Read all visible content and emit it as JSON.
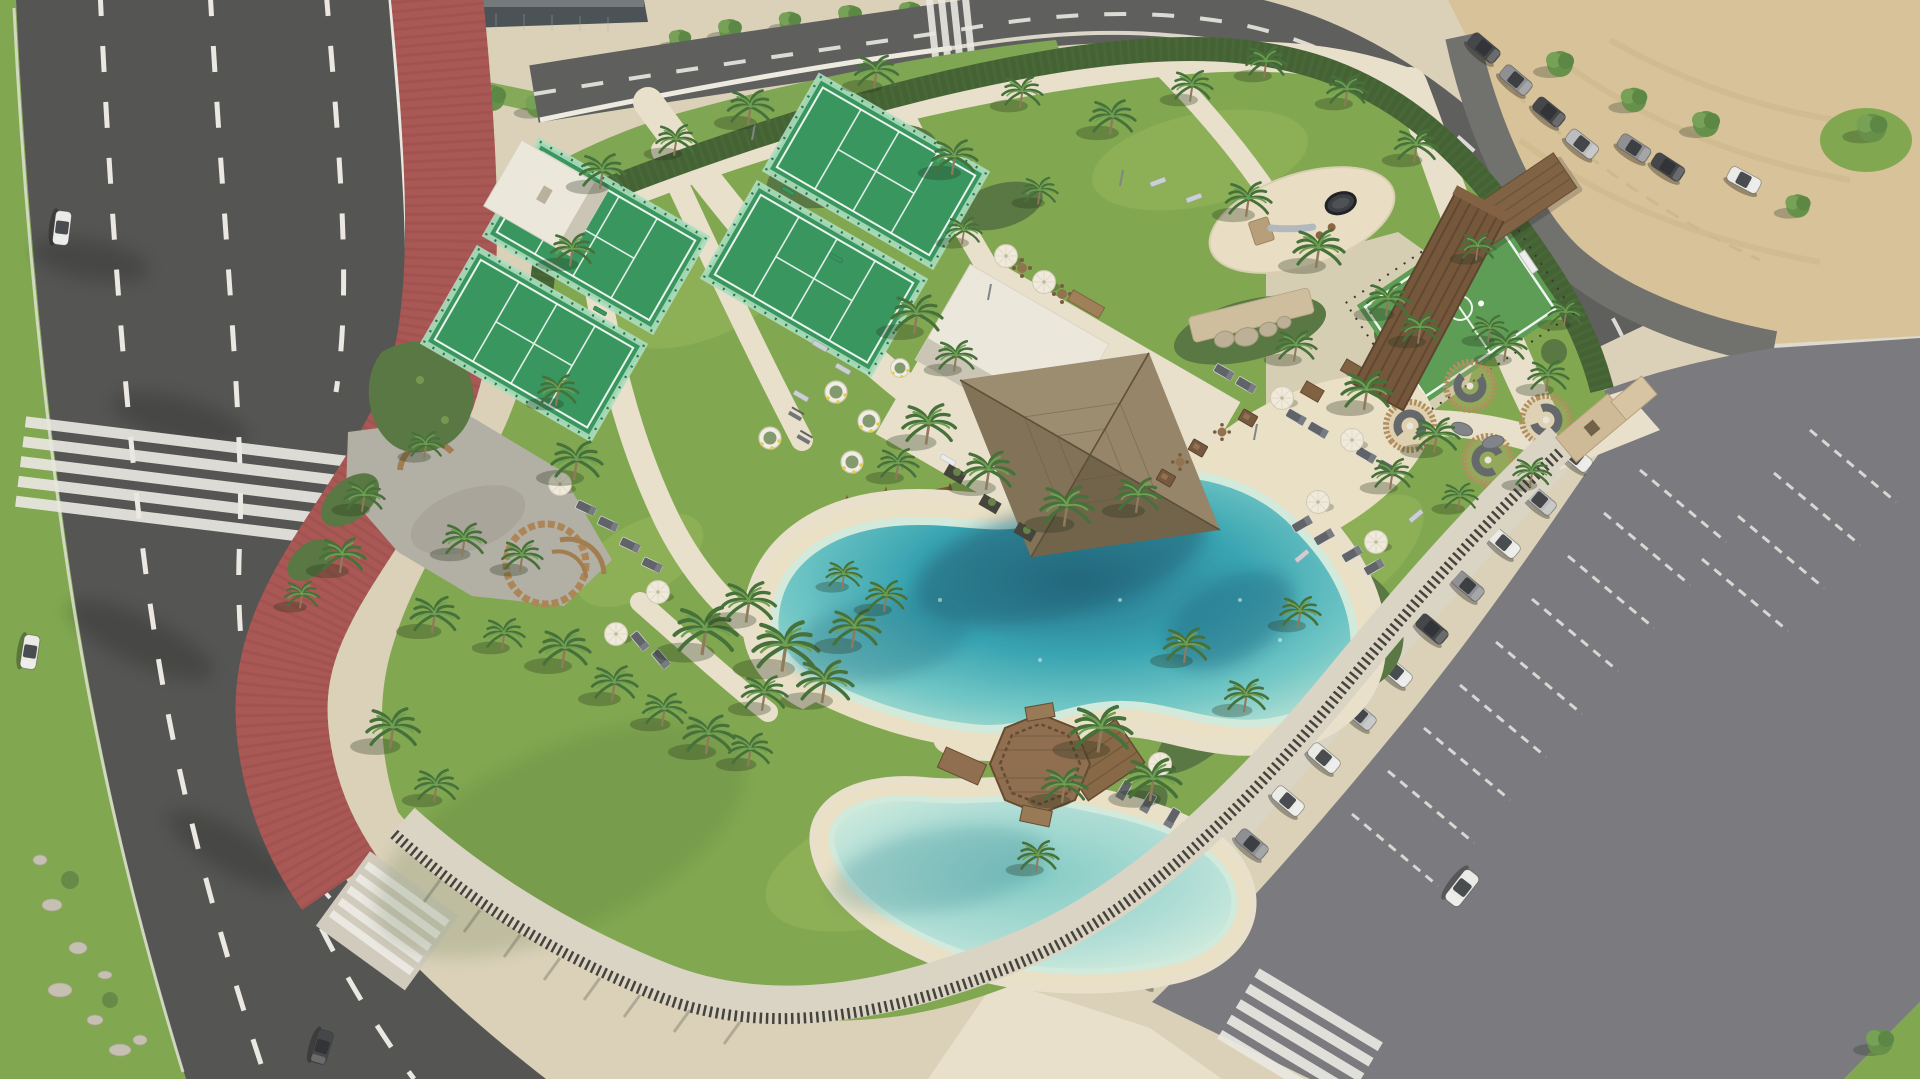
{
  "scene": {
    "type": "aerial-3d-architectural-render",
    "subject": "beach-club-sports-park-with-lagoon-pools",
    "no_visible_text": true,
    "areas": {
      "roads": [
        "coastal-road-left",
        "red-cycle-lane",
        "top-road",
        "service-road-top-right"
      ],
      "sports": [
        "padel-court-pair-west",
        "padel-court-pair-east",
        "multisport-turf-court",
        "playground-sand-oval",
        "outdoor-gym",
        "swing-frames"
      ],
      "water": [
        "main-lagoon-pool",
        "kids-lagoon-pool",
        "octagonal-wood-gazebo-deck"
      ],
      "buildings": [
        "glass-building-top-left",
        "changing-rooms-white",
        "club-house-white",
        "thatched-pavilion",
        "wood-entrance-tower",
        "turf-court-shelter"
      ],
      "amenities": [
        "seating-pods-circular",
        "bbq-dining-sets",
        "white-parasols",
        "sun-loungers",
        "planters-olive-trees",
        "circular-palm-bench",
        "climbing-rock-wall"
      ],
      "parking": [
        "east-parking-lot",
        "sand-beach-lot-top-right",
        "street-parking-top-left"
      ]
    },
    "counts": {
      "padel_courts": 4,
      "lagoon_pools": 2,
      "seating_pods": 4,
      "east_row_parked_cars": 13,
      "parasols_poolside": 7,
      "swing_frames": 2
    },
    "vehicles": [
      "white-suv-driving-in-parking",
      "white-car-on-road-top-left",
      "white-car-on-road-mid",
      "dark-car-on-road-bottom"
    ]
  },
  "palette": {
    "road": "#4c4c4c",
    "road_top": "#575757",
    "lane_mark": "#e9e7e1",
    "bike_lane": "#a5504d",
    "bike_stripe": "#8c403e",
    "pavement": "#d8cfb6",
    "pavement_bright": "#e7dfc9",
    "promenade": "#d9d2c3",
    "grass": "#7ba449",
    "grass_light": "#a3bd60",
    "hedge": "#3b5a2c",
    "shrub": "#52713a",
    "sand_lot": "#d6bf96",
    "sand_beach": "#e9dfc4",
    "pool_deep": "#17647f",
    "pool_mid": "#2fa0af",
    "pool_shallow": "#79cac6",
    "pool_rim": "#cfe9dc",
    "court_turf": "#2f9158",
    "court_glass": "#a7dcbd",
    "court_frame": "#1e6f45",
    "sport_turf": "#55984f",
    "building_white": "#eae6db",
    "building_shade": "#c9c2b3",
    "thatch_light": "#917f61",
    "thatch_dark": "#6b5b43",
    "wood": "#8a6848",
    "wood_dark": "#5e4228",
    "fence": "#3b3933",
    "parking": "#74747a",
    "gravel": "#aeaba1",
    "gravel_dark": "#5e6064",
    "car_white": "#e9e9e7",
    "car_silver": "#b9babc",
    "car_gray": "#8a8b8f",
    "car_dark": "#3c3e42",
    "umbrella": "#efe9db",
    "lounger": "#585b60",
    "pod_wood": "#ad8a58",
    "sofa": "#5e6165",
    "rock": "#b9ad95"
  }
}
